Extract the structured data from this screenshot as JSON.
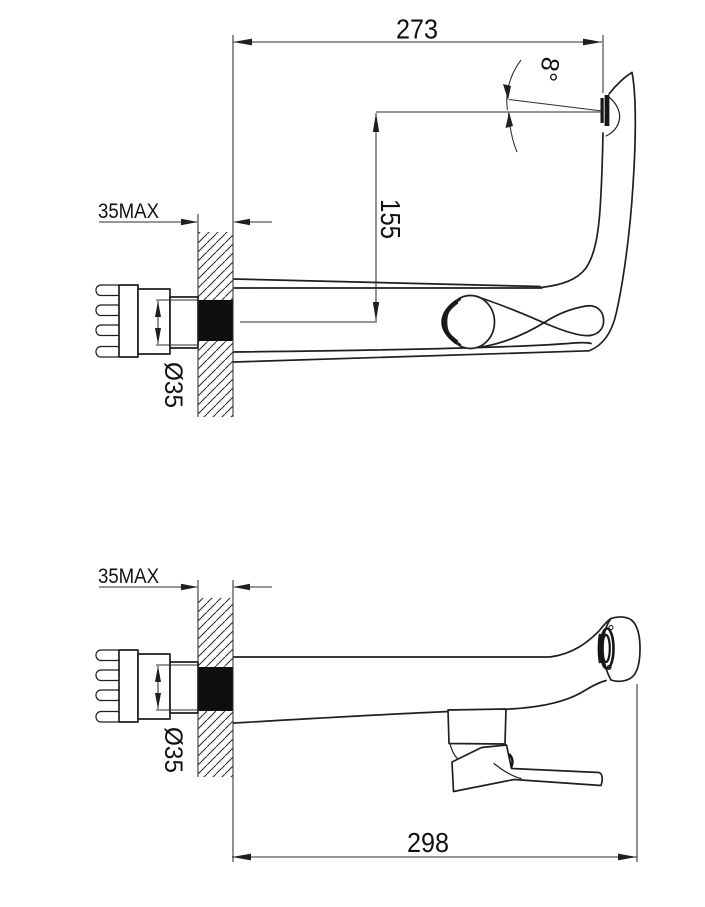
{
  "drawing": {
    "type": "technical-drawing",
    "subject": "wall-mounted faucet, two side views (spout raised / spout lowered)",
    "colors": {
      "line": "#1f1f1f",
      "dimension_line": "#2e2e2e",
      "background": "#ffffff",
      "section_fill": "#0e0e0e"
    },
    "views": {
      "top": {
        "name": "spout-raised-view",
        "dim_width": "273",
        "dim_height": "155",
        "dim_angle": "8°",
        "dim_wall": "35MAX",
        "dim_diameter": "Ø35"
      },
      "bottom": {
        "name": "spout-lowered-view",
        "dim_length": "298",
        "dim_wall": "35MAX",
        "dim_diameter": "Ø35"
      }
    }
  }
}
